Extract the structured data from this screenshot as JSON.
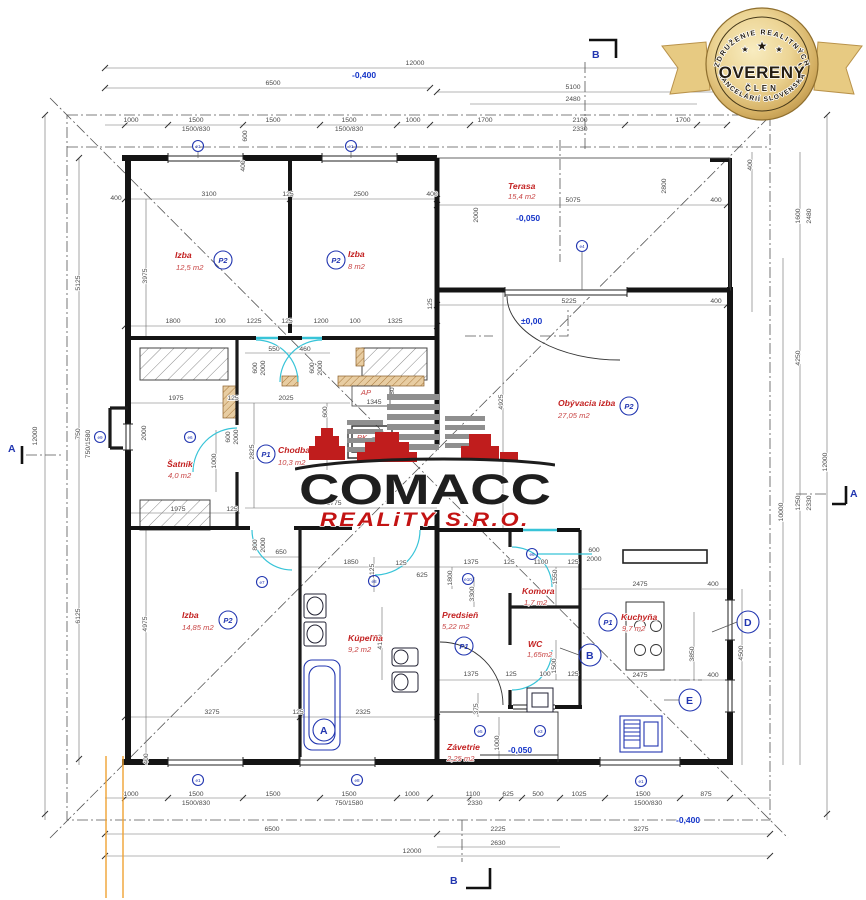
{
  "badge": {
    "arc_top": "ZDRUŽENIE REALITNÝCH",
    "word": "OVERENÝ",
    "sub": "ČLEN",
    "arc_bottom": "KANCELÁRIÍ SLOVENSKA",
    "star_big": "★",
    "star_small": "★"
  },
  "watermark": {
    "brand": "COMACC",
    "sub": "REALiTY S.R.O."
  },
  "rooms": {
    "izba1": {
      "name": "Izba",
      "area": "12,5 m2",
      "mark": "P2"
    },
    "izba2": {
      "name": "Izba",
      "area": "8 m2",
      "mark": "P2"
    },
    "terasa": {
      "name": "Terasa",
      "area": "15,4 m2"
    },
    "obyvacia": {
      "name": "Obývacia izba",
      "area": "27,05 m2",
      "mark": "P2"
    },
    "satnik": {
      "name": "Šatník",
      "area": "4,0 m2"
    },
    "chodba": {
      "name": "Chodba",
      "area": "10,3 m2",
      "mark": "P1"
    },
    "izba3": {
      "name": "Izba",
      "area": "14,85 m2",
      "mark": "P2"
    },
    "kupelna": {
      "name": "Kúpeľňa",
      "area": "9,2 m2"
    },
    "predsien": {
      "name": "Predsieň",
      "area": "5,22 m2",
      "mark": "P1"
    },
    "komora": {
      "name": "Komora",
      "area": "1,7 m2"
    },
    "wc": {
      "name": "WC",
      "area": "1,65m2"
    },
    "kuchyna": {
      "name": "Kuchyňa",
      "area": "9,7 m2",
      "mark": "P1"
    },
    "zavetrie": {
      "name": "Závetrie",
      "area": "2,25 m2"
    }
  },
  "levels": {
    "top": "-0,400",
    "terasa": "-0,050",
    "interior": "±0,00",
    "zavetrie": "-0,050",
    "bottom": "-0,400"
  },
  "sections": {
    "a": "A",
    "b": "B",
    "d": "D",
    "e": "E"
  },
  "emarks": {
    "e1": "e1",
    "e3": "e3",
    "e4": "e4",
    "e5": "e5",
    "e6": "e6",
    "e7": "e7",
    "e8": "e8",
    "e9": "e9",
    "e10": "e10"
  },
  "labels": {
    "ap": "AP",
    "ap_size": "1345",
    "pk": "PK"
  },
  "dims": {
    "top": [
      "12000",
      "6500",
      "1000",
      "1500",
      "1500/830",
      "1500",
      "1500",
      "1500/830",
      "1000",
      "600",
      "5100",
      "2480",
      "1700",
      "2100",
      "2330",
      "1700"
    ],
    "left": [
      "12000",
      "5125",
      "750",
      "750/1580",
      "6125",
      "400"
    ],
    "right": [
      "400",
      "1600",
      "2480",
      "4250",
      "1250",
      "2330",
      "10000",
      "12000"
    ],
    "bottom": [
      "1000",
      "1500",
      "1500/830",
      "1500",
      "1500",
      "750/1580",
      "1000",
      "1100",
      "2330",
      "625",
      "500",
      "1025",
      "1500",
      "1500/830",
      "875",
      "2225",
      "3275",
      "2630",
      "6500",
      "12000"
    ],
    "bed": [
      "3100",
      "125",
      "2500",
      "400",
      "3975",
      "1800",
      "100",
      "1225",
      "125",
      "1200",
      "100",
      "1325",
      "125",
      "400"
    ],
    "ter": [
      "2000",
      "5075",
      "2800",
      "400",
      "5225",
      "400",
      "4925"
    ],
    "mid": [
      "550",
      "460",
      "600",
      "2000",
      "600",
      "2000",
      "1975",
      "125",
      "2025",
      "380",
      "600",
      "725",
      "2000",
      "600",
      "2000",
      "1000",
      "2825",
      "3775",
      "1975",
      "125"
    ],
    "bath": [
      "650",
      "800",
      "2000",
      "4975",
      "1850",
      "1125",
      "125",
      "625",
      "4150",
      "3275",
      "125",
      "2325",
      "400"
    ],
    "kit": [
      "1375",
      "125",
      "1100",
      "125",
      "1550",
      "600",
      "2000",
      "1800",
      "3300",
      "2475",
      "400",
      "2475",
      "400",
      "4500",
      "3850",
      "1375",
      "125",
      "100",
      "125",
      "1500",
      "375",
      "1000"
    ]
  }
}
